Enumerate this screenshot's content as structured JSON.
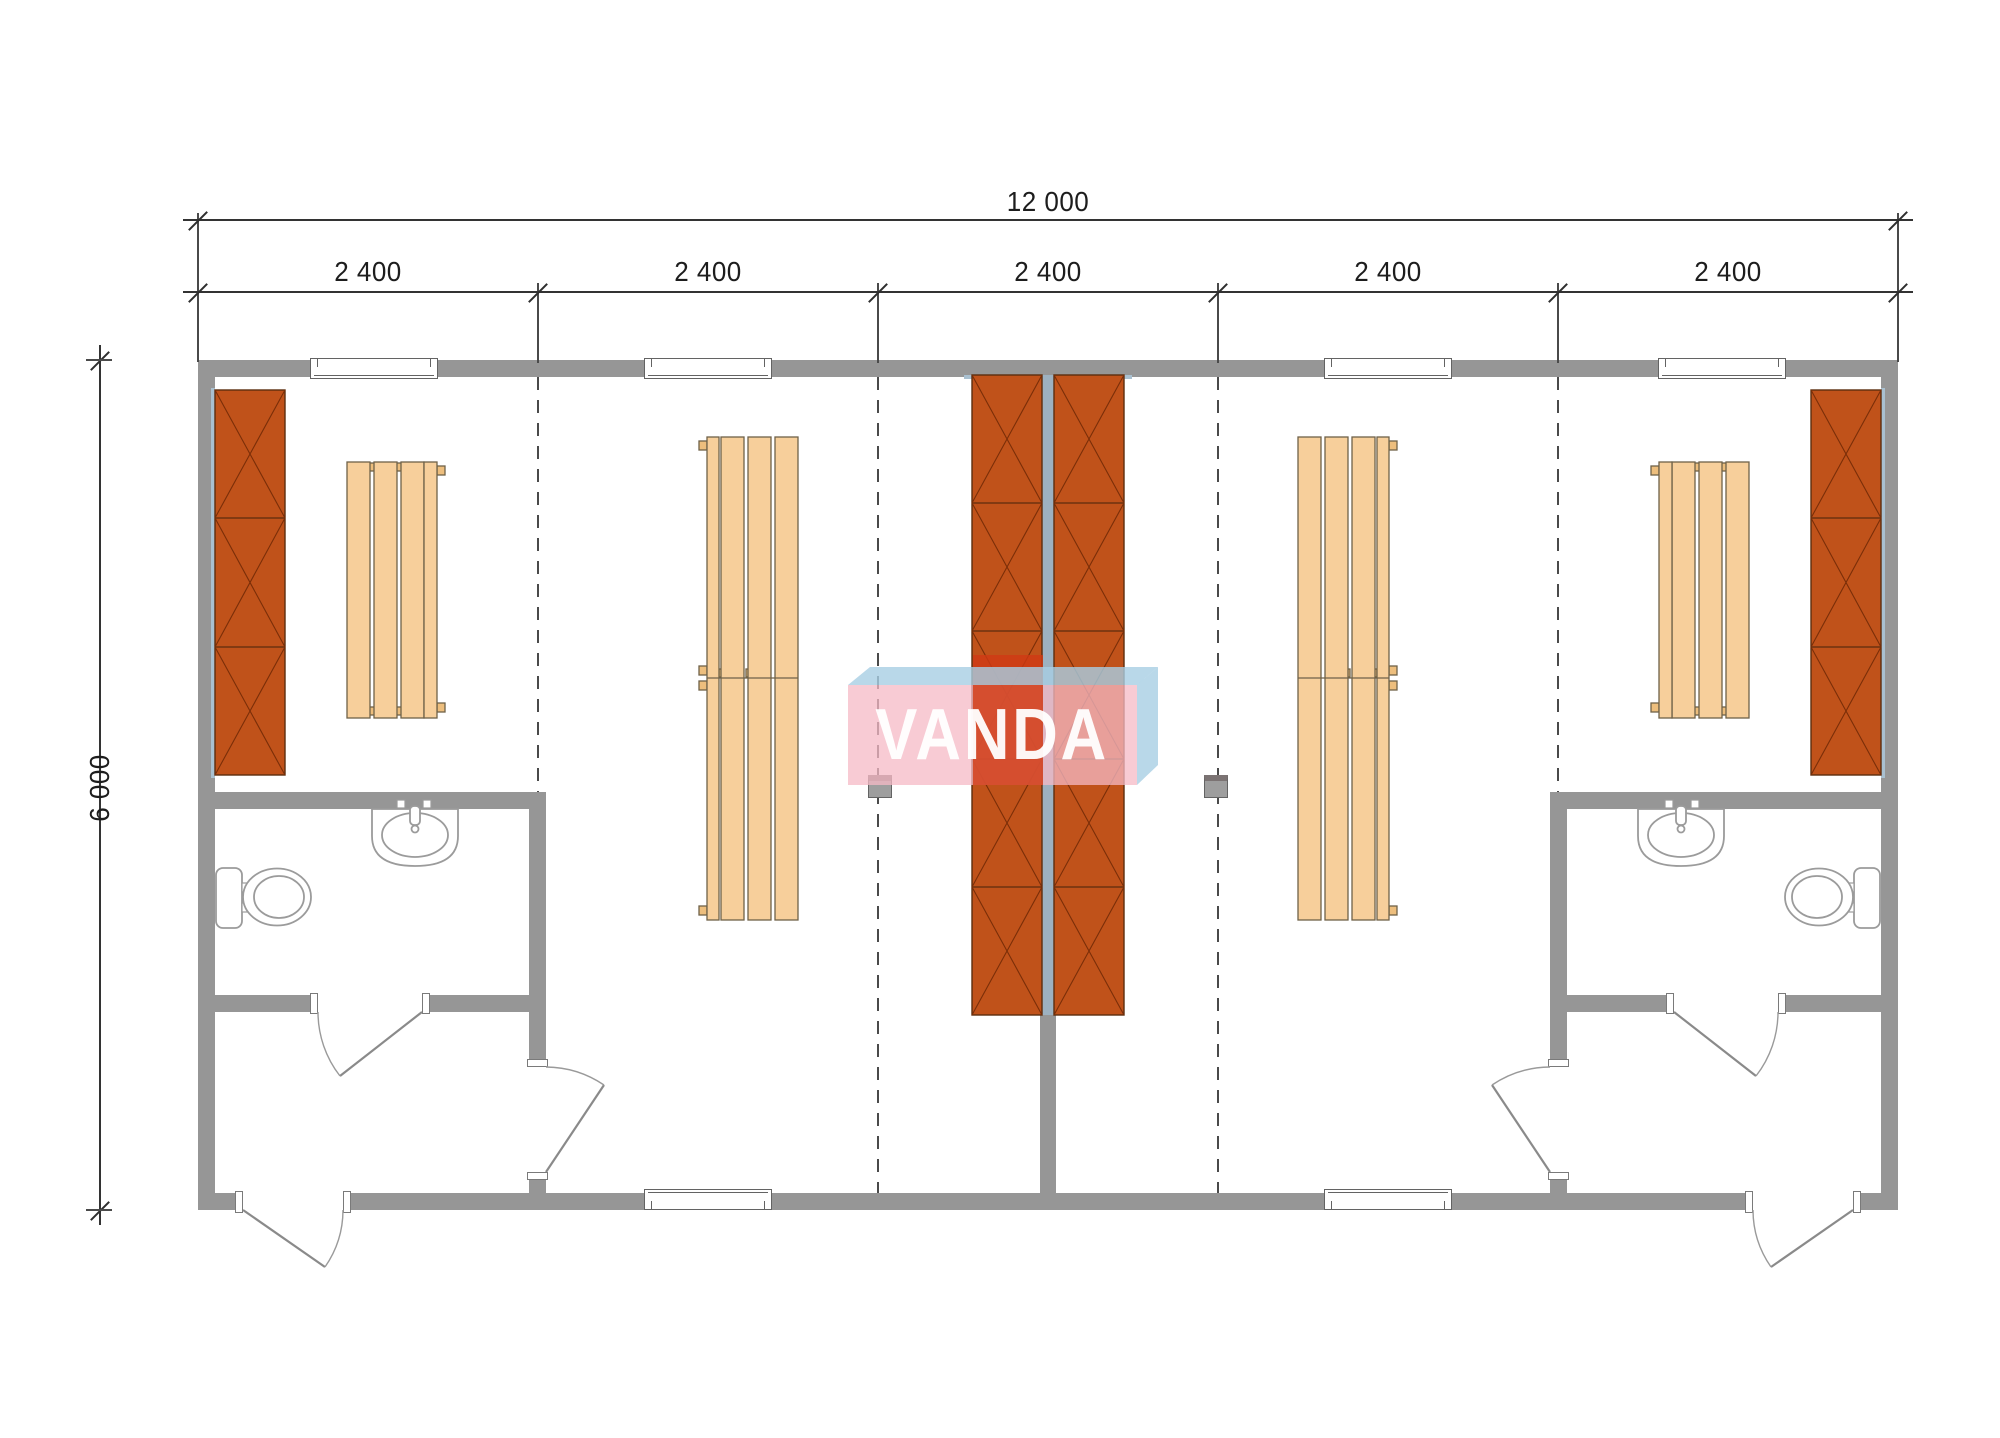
{
  "drawing": {
    "type": "modular building floor plan",
    "watermark_text": "VANDA",
    "dimensions": {
      "total_width_label": "12 000",
      "module_labels": [
        "2 400",
        "2 400",
        "2 400",
        "2 400",
        "2 400"
      ],
      "height_label": "6 000"
    },
    "colors": {
      "wall_gray": "#969696",
      "center_wall_lining_blue": "#9db1c0",
      "wardrobe_panel_orange": "#c0521a",
      "panel_line_dark": "#6b2a08",
      "bench_tan": "#f7cf9b",
      "bench_outline": "#6f6249",
      "dimension_text": "#1d1d1d",
      "watermark_pink": "rgba(246,186,198,0.75)",
      "watermark_red": "rgba(208,58,20,0.80)",
      "watermark_blue": "rgba(168,206,228,0.80)"
    },
    "elements": {
      "modules": 5,
      "bathrooms": 2,
      "entrance_doors": 2,
      "windows_top": 2,
      "windows_bottom": 1
    }
  }
}
